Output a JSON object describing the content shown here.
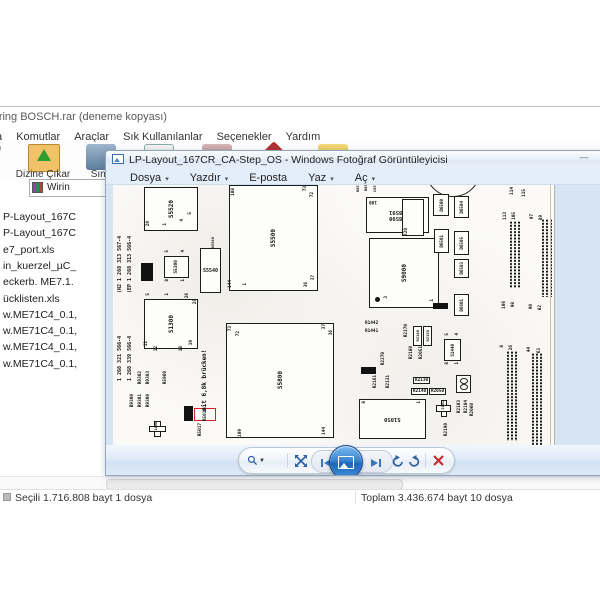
{
  "winrar": {
    "title": "Wiring BOSCH.rar (deneme kopyası)",
    "menu": [
      "Dosya",
      "Komutlar",
      "Araçlar",
      "Sık Kullanılanlar",
      "Seçenekler",
      "Yardım"
    ],
    "toolbar": [
      {
        "label": "Ekle",
        "icon": "add-books-icon"
      },
      {
        "label": "Dizine Çıkar",
        "icon": "extract-folder-icon"
      },
      {
        "label": "Sına",
        "icon": "test-icon"
      },
      {
        "label": "Görüntüle",
        "icon": "view-icon"
      },
      {
        "label": "Sil",
        "icon": "delete-icon"
      },
      {
        "label": "Bul",
        "icon": "find-icon"
      },
      {
        "label": "Sihirbaz",
        "icon": "wizard-icon"
      }
    ],
    "address": "Wirin",
    "files": [
      "P-Layout_167C",
      "P-Layout_167C",
      "e7_port.xls",
      "in_kuerzel_µC_",
      "eckerb. ME7.1.",
      "ücklisten.xls",
      "w.ME71C4_0.1,",
      "w.ME71C4_0.1,",
      "w.ME71C4_0.1,",
      "w.ME71C4_0.1,"
    ],
    "status_left": "Seçili 1.716.808 bayt 1 dosya",
    "status_right": "Toplam 3.436.674 bayt 10 dosya"
  },
  "viewer": {
    "title": "LP-Layout_167CR_CA-Step_OS - Windows Fotoğraf Görüntüleyicisi",
    "minimize": "—",
    "menu": [
      {
        "label": "Dosya",
        "arrow": "▾"
      },
      {
        "label": "Yazdır",
        "arrow": "▾"
      },
      {
        "label": "E-posta",
        "arrow": ""
      },
      {
        "label": "Yaz",
        "arrow": "▾"
      },
      {
        "label": "Aç",
        "arrow": "▾"
      }
    ],
    "toolbar_icons": [
      "zoom-magnifier",
      "fit-to-window",
      "previous",
      "slideshow",
      "next",
      "rotate-ccw",
      "rotate-cw",
      "delete"
    ],
    "accent_blue": "#2f7fd3",
    "delete_red": "#c22a2a"
  },
  "pcb": {
    "red_annotation": "mit 6,8k brücken!",
    "components": [
      {
        "t": "lab",
        "x": 4,
        "y": 8,
        "h": 100,
        "fs": 5,
        "label": "(N2 1 268 313 567-4"
      },
      {
        "t": "lab",
        "x": 14,
        "y": 8,
        "h": 100,
        "fs": 5,
        "label": "(EP 1 268 313 566-4"
      },
      {
        "t": "lab",
        "x": 4,
        "y": 116,
        "h": 80,
        "fs": 5,
        "label": "1 268 321 566-4"
      },
      {
        "t": "lab",
        "x": 14,
        "y": 116,
        "h": 80,
        "fs": 5,
        "label": "1 268 339 566-4"
      },
      {
        "t": "chip",
        "x": 31,
        "y": 2,
        "w": 54,
        "h": 44,
        "fs": 6,
        "label": "S5520"
      },
      {
        "t": "pin",
        "x": 33,
        "y": 36,
        "label": "20"
      },
      {
        "t": "pin",
        "x": 50,
        "y": 38,
        "label": "1"
      },
      {
        "t": "pin",
        "x": 67,
        "y": 34,
        "label": "4"
      },
      {
        "t": "pin",
        "x": 75,
        "y": 27,
        "label": "5"
      },
      {
        "t": "chip",
        "x": 116,
        "y": 0,
        "w": 89,
        "h": 106,
        "fs": 6,
        "label": "S5500"
      },
      {
        "t": "pin",
        "x": 118,
        "y": 3,
        "label": "108"
      },
      {
        "t": "pin",
        "x": 190,
        "y": 1,
        "label": "73"
      },
      {
        "t": "pin",
        "x": 197,
        "y": 7,
        "label": "72"
      },
      {
        "t": "pin",
        "x": 115,
        "y": 95,
        "label": "144"
      },
      {
        "t": "pin",
        "x": 130,
        "y": 98,
        "label": "1"
      },
      {
        "t": "pin",
        "x": 191,
        "y": 97,
        "label": "36"
      },
      {
        "t": "pin",
        "x": 198,
        "y": 90,
        "label": "37"
      },
      {
        "t": "oval",
        "x": 87,
        "y": 63,
        "w": 21,
        "h": 45,
        "fs": 5,
        "label": "S5540"
      },
      {
        "t": "lab",
        "x": 97,
        "y": 52,
        "fs": 3.8,
        "label": "B5540"
      },
      {
        "t": "chip",
        "x": 51,
        "y": 71,
        "w": 25,
        "h": 22,
        "fs": 4.5,
        "label": "S5300"
      },
      {
        "t": "pin",
        "x": 52,
        "y": 65,
        "label": "5"
      },
      {
        "t": "pin",
        "x": 68,
        "y": 65,
        "label": "4"
      },
      {
        "t": "pin",
        "x": 52,
        "y": 94,
        "label": "8"
      },
      {
        "t": "pin",
        "x": 68,
        "y": 94,
        "label": "1"
      },
      {
        "t": "bbox",
        "x": 28,
        "y": 78,
        "w": 12,
        "h": 18,
        "fs": 4,
        "label": "S5530"
      },
      {
        "t": "chip",
        "x": 31,
        "y": 114,
        "w": 54,
        "h": 50,
        "fs": 6,
        "label": "S1300"
      },
      {
        "t": "pin",
        "x": 33,
        "y": 108,
        "label": "5"
      },
      {
        "t": "pin",
        "x": 52,
        "y": 108,
        "label": "1"
      },
      {
        "t": "pin",
        "x": 72,
        "y": 108,
        "label": "26"
      },
      {
        "t": "pin",
        "x": 80,
        "y": 114,
        "label": "25"
      },
      {
        "t": "pin",
        "x": 31,
        "y": 156,
        "label": "11"
      },
      {
        "t": "pin",
        "x": 41,
        "y": 161,
        "label": "12"
      },
      {
        "t": "pin",
        "x": 66,
        "y": 161,
        "label": "18"
      },
      {
        "t": "pin",
        "x": 76,
        "y": 155,
        "label": "19"
      },
      {
        "t": "chipU",
        "x": 253,
        "y": 12,
        "w": 63,
        "h": 36,
        "fs": 5.5,
        "label": "S8590\nS8591"
      },
      {
        "t": "pinU",
        "x": 256,
        "y": 14,
        "label": "100"
      },
      {
        "t": "circ",
        "x": 312,
        "y": -44,
        "w": 56,
        "h": 56
      },
      {
        "t": "lab",
        "x": 242,
        "y": -2,
        "fs": 3.8,
        "label": "R851"
      },
      {
        "t": "lab",
        "x": 250,
        "y": -3,
        "fs": 3.8,
        "label": "B850"
      },
      {
        "t": "lab",
        "x": 259,
        "y": -2,
        "fs": 3.8,
        "label": "C859"
      },
      {
        "t": "chip",
        "x": 289,
        "y": 14,
        "w": 22,
        "h": 37,
        "fs": 4,
        "label": ""
      },
      {
        "t": "pin",
        "x": 291,
        "y": 43,
        "label": "220"
      },
      {
        "t": "chip",
        "x": 256,
        "y": 53,
        "w": 70,
        "h": 70,
        "fs": 6,
        "label": "S9000"
      },
      {
        "t": "dot",
        "x": 262,
        "y": 112,
        "w": 5,
        "h": 5
      },
      {
        "t": "pin",
        "x": 271,
        "y": 111,
        "label": "3"
      },
      {
        "t": "pin",
        "x": 317,
        "y": 114,
        "label": "1"
      },
      {
        "t": "box",
        "x": 320,
        "y": 9,
        "w": 16,
        "h": 22,
        "fs": 4.2,
        "label": "D6500"
      },
      {
        "t": "box",
        "x": 341,
        "y": 11,
        "w": 15,
        "h": 22,
        "fs": 4.2,
        "label": "D6504"
      },
      {
        "t": "box",
        "x": 321,
        "y": 44,
        "w": 15,
        "h": 24,
        "fs": 4.2,
        "label": "D6501"
      },
      {
        "t": "box",
        "x": 341,
        "y": 46,
        "w": 15,
        "h": 24,
        "fs": 4.2,
        "label": "D6505"
      },
      {
        "t": "box",
        "x": 341,
        "y": 74,
        "w": 15,
        "h": 19,
        "fs": 4.2,
        "label": "D6503"
      },
      {
        "t": "box",
        "x": 341,
        "y": 109,
        "w": 15,
        "h": 22,
        "fs": 4.2,
        "label": "D6601"
      },
      {
        "t": "bboxh",
        "x": 320,
        "y": 118,
        "w": 15,
        "h": 6,
        "label": "10K"
      },
      {
        "t": "strip",
        "x": 396,
        "y": 36,
        "w": 13,
        "h": 67
      },
      {
        "t": "strip",
        "x": 428,
        "y": 34,
        "w": 12,
        "h": 78
      },
      {
        "t": "strip",
        "x": 393,
        "y": 166,
        "w": 13,
        "h": 90
      },
      {
        "t": "strip",
        "x": 418,
        "y": 168,
        "w": 13,
        "h": 92
      },
      {
        "t": "pin",
        "x": 397,
        "y": 2,
        "label": "114"
      },
      {
        "t": "pin",
        "x": 409,
        "y": 4,
        "label": "115"
      },
      {
        "t": "pin",
        "x": 390,
        "y": 27,
        "label": "113"
      },
      {
        "t": "pin",
        "x": 399,
        "y": 27,
        "label": "105"
      },
      {
        "t": "pin",
        "x": 417,
        "y": 29,
        "label": "97"
      },
      {
        "t": "pin",
        "x": 426,
        "y": 30,
        "label": "89"
      },
      {
        "t": "pin",
        "x": 389,
        "y": 116,
        "label": "106"
      },
      {
        "t": "pin",
        "x": 398,
        "y": 117,
        "label": "98"
      },
      {
        "t": "pin",
        "x": 416,
        "y": 119,
        "label": "90"
      },
      {
        "t": "pin",
        "x": 425,
        "y": 120,
        "label": "82"
      },
      {
        "t": "pin",
        "x": 387,
        "y": 160,
        "label": "8"
      },
      {
        "t": "pin",
        "x": 396,
        "y": 160,
        "label": "26"
      },
      {
        "t": "pin",
        "x": 414,
        "y": 162,
        "label": "44"
      },
      {
        "t": "pin",
        "x": 424,
        "y": 163,
        "label": "63"
      },
      {
        "t": "chip",
        "x": 113,
        "y": 138,
        "w": 108,
        "h": 115,
        "fs": 6,
        "label": "S5800"
      },
      {
        "t": "pin",
        "x": 115,
        "y": 141,
        "label": "73"
      },
      {
        "t": "pin",
        "x": 123,
        "y": 146,
        "label": "72"
      },
      {
        "t": "pin",
        "x": 209,
        "y": 139,
        "label": "37"
      },
      {
        "t": "pin",
        "x": 216,
        "y": 145,
        "label": "36"
      },
      {
        "t": "pin",
        "x": 125,
        "y": 244,
        "label": "109"
      },
      {
        "t": "pin",
        "x": 209,
        "y": 242,
        "label": "144"
      },
      {
        "t": "lab",
        "x": 25,
        "y": 186,
        "label": "R9302"
      },
      {
        "t": "lab",
        "x": 33,
        "y": 186,
        "label": "R9303"
      },
      {
        "t": "lab",
        "x": 17,
        "y": 209,
        "label": "B9300"
      },
      {
        "t": "lab",
        "x": 25,
        "y": 209,
        "label": "R9301"
      },
      {
        "t": "lab",
        "x": 33,
        "y": 209,
        "label": "R9300"
      },
      {
        "t": "lab",
        "x": 50,
        "y": 186,
        "label": "R5960"
      },
      {
        "t": "bbox",
        "x": 71,
        "y": 221,
        "w": 9,
        "h": 15,
        "fs": 3.6,
        "label": "R5060"
      },
      {
        "t": "redbox",
        "x": 81,
        "y": 223,
        "w": 22,
        "h": 13,
        "fs": 4.4,
        "label": "R5010"
      },
      {
        "t": "lab",
        "x": 85,
        "y": 238,
        "label": "R5017"
      },
      {
        "t": "redtext",
        "x": 88,
        "y": 158,
        "h": 68,
        "fs": 6,
        "label": "mit 6,8k brücken!"
      },
      {
        "t": "cross",
        "x": 36,
        "y": 236,
        "w": 17,
        "h": 16,
        "label": "1400"
      },
      {
        "t": "labh",
        "x": 252,
        "y": 136,
        "label": "R1442"
      },
      {
        "t": "labh",
        "x": 252,
        "y": 144,
        "label": "R1441"
      },
      {
        "t": "lab",
        "x": 291,
        "y": 139,
        "label": "R2170"
      },
      {
        "t": "box",
        "x": 300,
        "y": 141,
        "w": 9,
        "h": 20,
        "fs": 3.8,
        "label": "R2160"
      },
      {
        "t": "box",
        "x": 310,
        "y": 141,
        "w": 9,
        "h": 20,
        "fs": 3.8,
        "label": "R2150"
      },
      {
        "t": "lab",
        "x": 296,
        "y": 161,
        "label": "R2180"
      },
      {
        "t": "lab",
        "x": 306,
        "y": 161,
        "label": "R2051"
      },
      {
        "t": "lab",
        "x": 268,
        "y": 167,
        "label": "R2270"
      },
      {
        "t": "bboxh",
        "x": 248,
        "y": 182,
        "w": 15,
        "h": 7,
        "label": "10K"
      },
      {
        "t": "lab",
        "x": 260,
        "y": 190,
        "label": "R2161"
      },
      {
        "t": "lab",
        "x": 273,
        "y": 190,
        "label": "R2131"
      },
      {
        "t": "hbox",
        "x": 300,
        "y": 192,
        "w": 17,
        "h": 7,
        "label": "R2130"
      },
      {
        "t": "hbox",
        "x": 298,
        "y": 203,
        "w": 17,
        "h": 7,
        "label": "R2140"
      },
      {
        "t": "hbox",
        "x": 316,
        "y": 203,
        "w": 17,
        "h": 7,
        "label": "R2050"
      },
      {
        "t": "dbox",
        "x": 343,
        "y": 190,
        "w": 15,
        "h": 18,
        "label": "D9500"
      },
      {
        "t": "cross",
        "x": 323,
        "y": 215,
        "w": 15,
        "h": 17,
        "label": "2101"
      },
      {
        "t": "lab",
        "x": 344,
        "y": 215,
        "label": "R2103"
      },
      {
        "t": "lab",
        "x": 351,
        "y": 215,
        "label": "R2104"
      },
      {
        "t": "lab",
        "x": 357,
        "y": 218,
        "label": "R2060"
      },
      {
        "t": "lab",
        "x": 331,
        "y": 238,
        "label": "R2190"
      },
      {
        "t": "chip",
        "x": 331,
        "y": 154,
        "w": 17,
        "h": 22,
        "fs": 4.2,
        "label": "S1440"
      },
      {
        "t": "pin",
        "x": 332,
        "y": 148,
        "label": "5"
      },
      {
        "t": "pin",
        "x": 342,
        "y": 148,
        "label": "4"
      },
      {
        "t": "pin",
        "x": 332,
        "y": 177,
        "label": "8"
      },
      {
        "t": "pin",
        "x": 342,
        "y": 177,
        "label": "1"
      },
      {
        "t": "chipU",
        "x": 246,
        "y": 214,
        "w": 67,
        "h": 40,
        "fs": 5.5,
        "label": "S1050"
      },
      {
        "t": "pin",
        "x": 249,
        "y": 216,
        "label": "8"
      },
      {
        "t": "pin",
        "x": 304,
        "y": 216,
        "label": "1"
      },
      {
        "t": "vline",
        "x": 437,
        "y": 0,
        "w": 1,
        "h": 260
      }
    ]
  }
}
